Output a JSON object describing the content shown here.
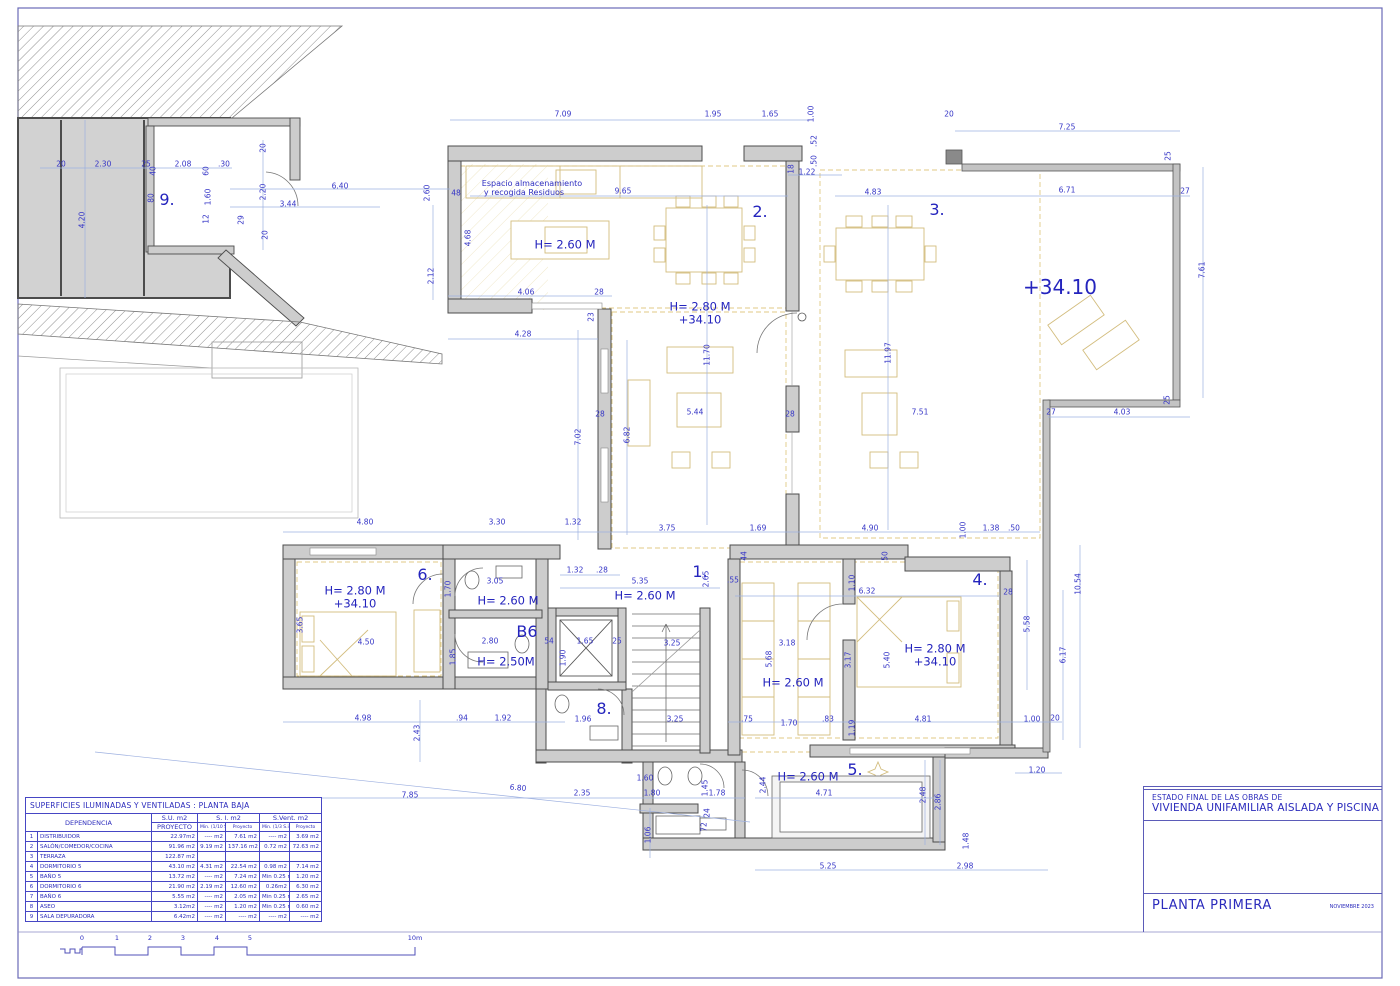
{
  "sheet": {
    "colors": {
      "annotation_blue": "#2b2bbc",
      "dim_line_blue": "#9db0e0",
      "wall_gray": "#cdcdcd",
      "furniture_tan": "#d3bd7e"
    },
    "title_block": {
      "project_line1": "ESTADO FINAL DE LAS OBRAS DE",
      "project_line2": "VIVIENDA UNIFAMILIAR AISLADA Y PISCINA",
      "sheet_name": "PLANTA PRIMERA",
      "date": "NOVIEMBRE 2023"
    },
    "scale_bar": {
      "labels": [
        {
          "t": "0",
          "x": 82
        },
        {
          "t": "1",
          "x": 117
        },
        {
          "t": "2",
          "x": 150
        },
        {
          "t": "3",
          "x": 183
        },
        {
          "t": "4",
          "x": 217
        },
        {
          "t": "5",
          "x": 250
        },
        {
          "t": "10m",
          "x": 415
        }
      ],
      "y": 942
    }
  },
  "areas_table": {
    "title": "SUPERFICIES ILUMINADAS Y VENTILADAS :  PLANTA BAJA",
    "headers": {
      "dependencia": "DEPENDENCIA",
      "su": "S.U. m2",
      "su_sub": "PROYECTO",
      "si": "S. I. m2",
      "si_min": "Min. (1/10 S.U.)",
      "si_proy": "Proyecto",
      "sv": "S.Vent. m2",
      "sv_min": "Min. (1/3 S.ilum.)",
      "sv_proy": "Proyecto"
    },
    "rows": [
      [
        "1",
        "DISTRIBUIDOR",
        "22.97m2",
        "---- m2",
        "7.61 m2",
        "---- m2",
        "3.69 m2"
      ],
      [
        "2",
        "SALÓN/COMEDOR/COCINA",
        "91.96 m2",
        "9.19 m2",
        "137.16 m2",
        "0.72 m2",
        "72.63 m2"
      ],
      [
        "3",
        "TERRAZA",
        "122.87 m2",
        "",
        "",
        "",
        ""
      ],
      [
        "4",
        "DORMITORIO 5",
        "43.10 m2",
        "4.31 m2",
        "22.54 m2",
        "0.98 m2",
        "7.14 m2"
      ],
      [
        "5",
        "BAÑO 5",
        "13.72 m2",
        "---- m2",
        "7.24 m2",
        "Min 0.25 m2",
        "1.20 m2"
      ],
      [
        "6",
        "DORMITORIO 6",
        "21.90 m2",
        "2.19 m2",
        "12.60 m2",
        "0.26m2",
        "6.30 m2"
      ],
      [
        "7",
        "BAÑO 6",
        "5.55 m2",
        "---- m2",
        "2.05 m2",
        "Min 0.25 m2",
        "2.65 m2"
      ],
      [
        "8",
        "ASEO",
        "3.12m2",
        "---- m2",
        "1.20 m2",
        "Min 0.25 m2",
        "0.60 m2"
      ],
      [
        "9",
        "SALA DEPURADORA",
        "6.42m2",
        "---- m2",
        "---- m2",
        "---- m2",
        "---- m2"
      ]
    ]
  },
  "plan": {
    "labels": [
      [
        "9.",
        167,
        200,
        0,
        "r"
      ],
      [
        "2.",
        760,
        212,
        0,
        "r"
      ],
      [
        "3.",
        937,
        210,
        0,
        "r"
      ],
      [
        "1.",
        700,
        572,
        0,
        "r"
      ],
      [
        "6.",
        425,
        575,
        0,
        "r"
      ],
      [
        "4.",
        980,
        580,
        0,
        "r"
      ],
      [
        "B6",
        527,
        632,
        0,
        "r"
      ],
      [
        "8.",
        604,
        709,
        0,
        "r"
      ],
      [
        "5.",
        855,
        770,
        0,
        "r"
      ],
      [
        "+34.10",
        1060,
        287,
        0,
        "l"
      ],
      [
        "H= 2.60 M",
        565,
        245,
        0,
        "h"
      ],
      [
        "H= 2.80 M",
        700,
        307,
        0,
        "h"
      ],
      [
        "+34.10",
        700,
        320,
        0,
        "h"
      ],
      [
        "H= 2.80 M",
        355,
        591,
        0,
        "h"
      ],
      [
        "+34.10",
        355,
        604,
        0,
        "h"
      ],
      [
        "H= 2.60 M",
        508,
        601,
        0,
        "h"
      ],
      [
        "H= 2.60 M",
        645,
        596,
        0,
        "h"
      ],
      [
        "H= 2.50M",
        506,
        662,
        0,
        "h"
      ],
      [
        "H= 2.60 M",
        793,
        683,
        0,
        "h"
      ],
      [
        "H= 2.80 M",
        935,
        649,
        0,
        "h"
      ],
      [
        "+34.10",
        935,
        662,
        0,
        "h"
      ],
      [
        "H= 2.60 M",
        808,
        777,
        0,
        "h"
      ],
      [
        "Espacio almacenamiento",
        532,
        184,
        0,
        "n"
      ],
      [
        "y recogida Residuos",
        524,
        193,
        0,
        "n"
      ],
      [
        "7.09",
        563,
        114
      ],
      [
        "1.95",
        713,
        114
      ],
      [
        "1.65",
        770,
        114
      ],
      [
        "1.00",
        811,
        114,
        -90
      ],
      [
        "20",
        949,
        114
      ],
      [
        "7.25",
        1067,
        127
      ],
      [
        ".52",
        814,
        141,
        -90
      ],
      [
        ".50",
        814,
        161,
        -90
      ],
      [
        "1.22",
        807,
        172
      ],
      [
        "20",
        61,
        164
      ],
      [
        "2.30",
        103,
        164
      ],
      [
        "25",
        146,
        164
      ],
      [
        "2.08",
        183,
        164
      ],
      [
        ".30",
        224,
        164
      ],
      [
        "4.20",
        82,
        220,
        -90
      ],
      [
        "40",
        153,
        171,
        -90
      ],
      [
        "80",
        151,
        198,
        -90
      ],
      [
        "60",
        206,
        171,
        -90
      ],
      [
        "1.60",
        208,
        197,
        -90
      ],
      [
        "12",
        206,
        219,
        -90
      ],
      [
        "29",
        241,
        220,
        -90
      ],
      [
        "20",
        263,
        148,
        -90
      ],
      [
        "2.20",
        263,
        192,
        -90
      ],
      [
        "20",
        265,
        235,
        -90
      ],
      [
        "3.44",
        288,
        204
      ],
      [
        "6.40",
        340,
        186
      ],
      [
        "2.60",
        427,
        193,
        -90
      ],
      [
        "48",
        456,
        193
      ],
      [
        "9.65",
        623,
        191
      ],
      [
        "4.68",
        468,
        238,
        -90
      ],
      [
        "2.12",
        431,
        276,
        -90
      ],
      [
        "4.06",
        526,
        292
      ],
      [
        "28",
        599,
        292
      ],
      [
        "4.28",
        523,
        334
      ],
      [
        "23",
        591,
        317,
        -90
      ],
      [
        "18",
        791,
        169,
        -90
      ],
      [
        "4.83",
        873,
        192
      ],
      [
        "6.71",
        1067,
        190
      ],
      [
        "27",
        1185,
        191
      ],
      [
        "25",
        1168,
        156,
        -90
      ],
      [
        "7.61",
        1202,
        270,
        -90
      ],
      [
        "27",
        1051,
        412
      ],
      [
        "4.03",
        1122,
        412
      ],
      [
        "25",
        1167,
        400,
        -90
      ],
      [
        "7.02",
        578,
        437,
        -90
      ],
      [
        "6.82",
        627,
        435,
        -90
      ],
      [
        "11.70",
        707,
        355,
        -90
      ],
      [
        "5.44",
        695,
        412
      ],
      [
        "28",
        600,
        414
      ],
      [
        "28",
        790,
        414
      ],
      [
        "11.97",
        888,
        353,
        -90
      ],
      [
        "7.51",
        920,
        412
      ],
      [
        "4.80",
        365,
        522
      ],
      [
        "3.30",
        497,
        522
      ],
      [
        "1.32",
        573,
        522
      ],
      [
        "3.75",
        667,
        528
      ],
      [
        "1.69",
        758,
        528
      ],
      [
        "4.90",
        870,
        528
      ],
      [
        "1.00",
        963,
        530,
        -90
      ],
      [
        "1.38",
        991,
        528
      ],
      [
        ".50",
        1014,
        528
      ],
      [
        "50",
        885,
        556,
        -90
      ],
      [
        "44",
        744,
        556,
        -90
      ],
      [
        "1.32",
        575,
        570
      ],
      [
        ".28",
        602,
        570
      ],
      [
        "5.35",
        640,
        581
      ],
      [
        "2.65",
        706,
        579,
        -90
      ],
      [
        ".55",
        733,
        580
      ],
      [
        "1.10",
        852,
        583,
        -90
      ],
      [
        "6.32",
        867,
        591
      ],
      [
        "28",
        1008,
        592
      ],
      [
        "10.54",
        1078,
        584,
        -90
      ],
      [
        "5.58",
        1027,
        624,
        -90
      ],
      [
        "6.17",
        1063,
        655,
        -90
      ],
      [
        "3.05",
        495,
        581
      ],
      [
        "1.70",
        448,
        589,
        -90
      ],
      [
        "3.65",
        300,
        625,
        -90
      ],
      [
        "4.50",
        366,
        642
      ],
      [
        "2.80",
        490,
        641
      ],
      [
        "54",
        549,
        641
      ],
      [
        "1.65",
        585,
        641
      ],
      [
        "25",
        617,
        641
      ],
      [
        "1.85",
        453,
        657,
        -90
      ],
      [
        "1.90",
        563,
        658,
        -90
      ],
      [
        "3.25",
        672,
        643
      ],
      [
        "3.25",
        675,
        719
      ],
      [
        "3.18",
        787,
        643
      ],
      [
        "3.17",
        848,
        660,
        -90
      ],
      [
        "5.40",
        887,
        660,
        -90
      ],
      [
        "5.68",
        769,
        659,
        -90
      ],
      [
        "4.98",
        363,
        718
      ],
      [
        ".94",
        462,
        718
      ],
      [
        "1.92",
        503,
        718
      ],
      [
        "2.43",
        417,
        733,
        -90
      ],
      [
        "1.96",
        583,
        719
      ],
      [
        ".75",
        747,
        719
      ],
      [
        "1.70",
        789,
        723
      ],
      [
        ".83",
        828,
        719
      ],
      [
        "1.19",
        852,
        728,
        -90
      ],
      [
        "4.81",
        923,
        719
      ],
      [
        "1.00",
        1032,
        719
      ],
      [
        "20",
        1055,
        718
      ],
      [
        "1.20",
        1037,
        770
      ],
      [
        "7.85",
        410,
        795
      ],
      [
        "6.80",
        518,
        788,
        5
      ],
      [
        "2.35",
        582,
        793
      ],
      [
        "1.80",
        652,
        793
      ],
      [
        "1.60",
        645,
        778
      ],
      [
        "1.06",
        648,
        835,
        -90
      ],
      [
        "1.45",
        705,
        788,
        -90
      ],
      [
        "1.78",
        717,
        793
      ],
      [
        "72",
        704,
        827,
        -90
      ],
      [
        "24",
        707,
        813,
        -90
      ],
      [
        "2.44",
        763,
        785,
        -90
      ],
      [
        "4.71",
        824,
        793
      ],
      [
        "2.48",
        923,
        795,
        -90
      ],
      [
        "2.86",
        938,
        802,
        -90
      ],
      [
        "5.25",
        828,
        866
      ],
      [
        "2.98",
        965,
        866
      ],
      [
        "1.48",
        966,
        841,
        -90
      ]
    ]
  }
}
